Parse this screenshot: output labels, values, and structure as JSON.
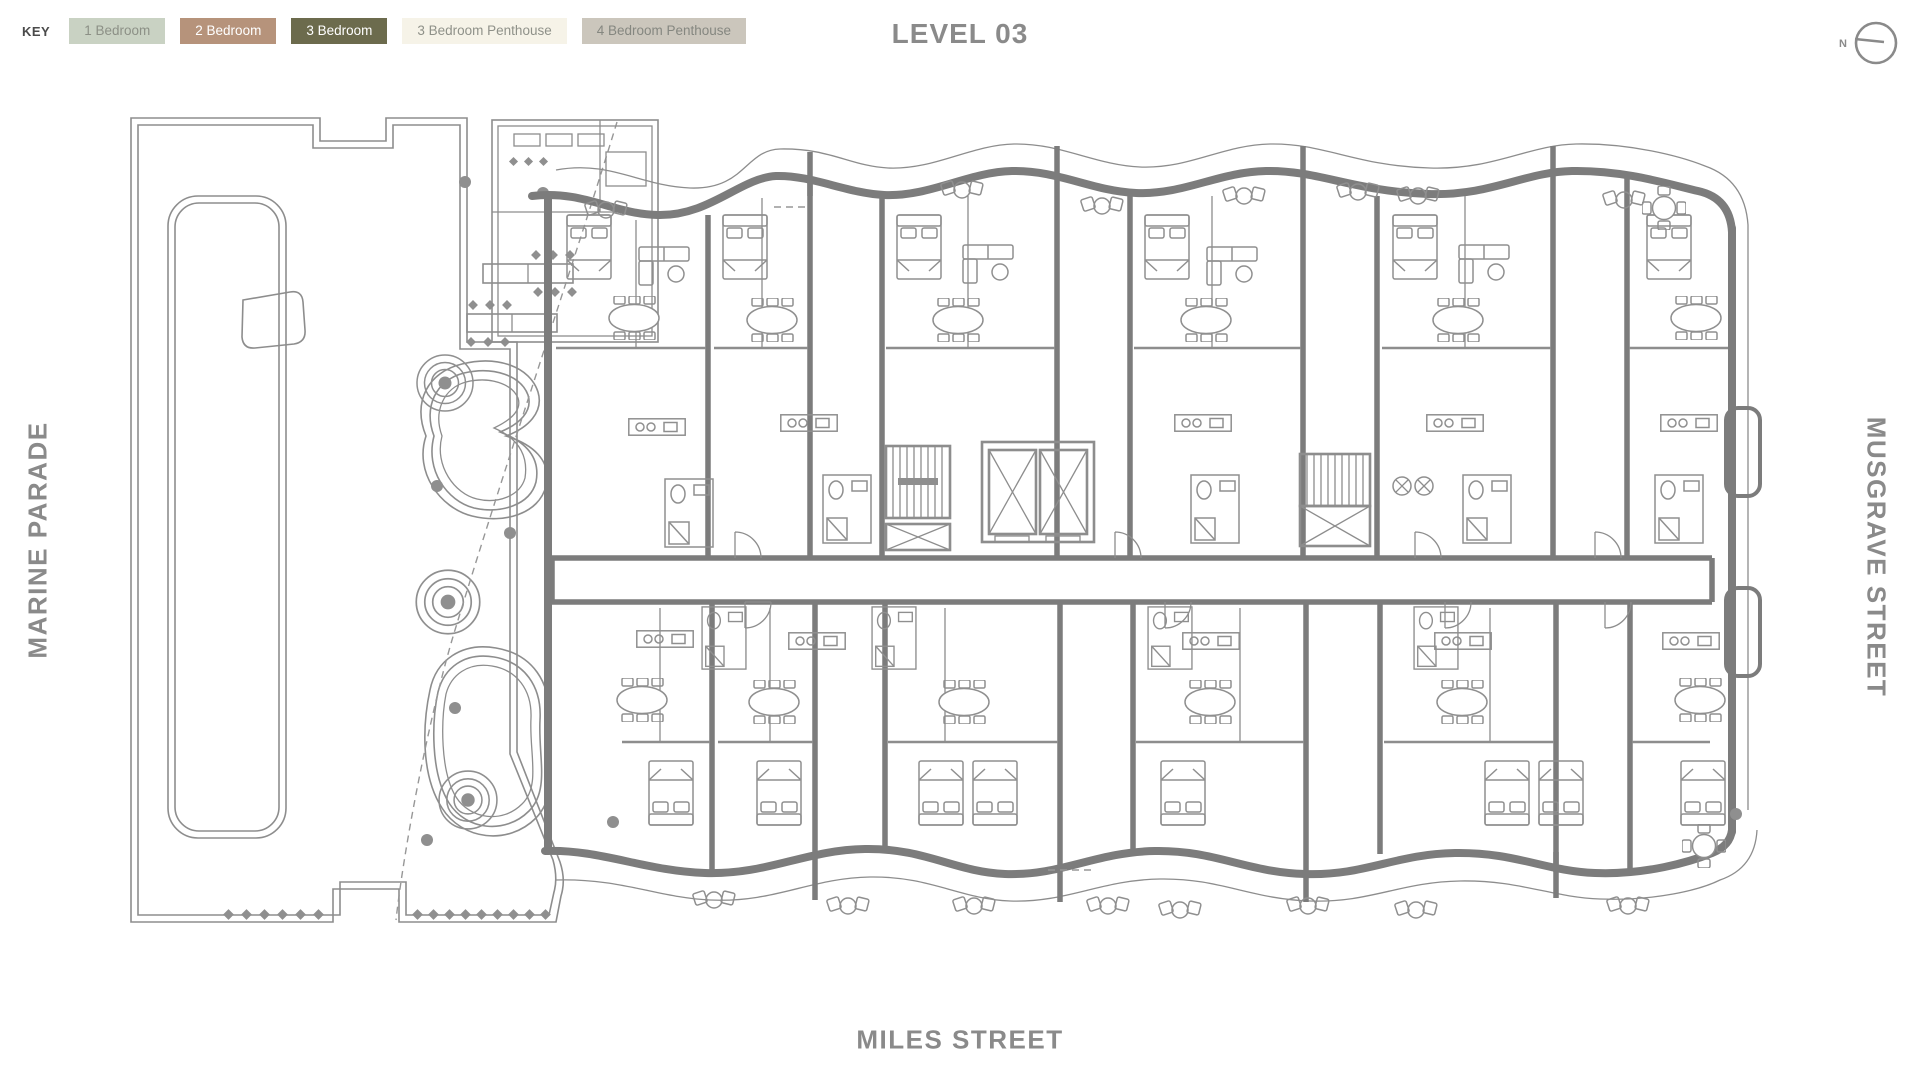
{
  "header": {
    "key_label": "KEY",
    "key_items": [
      {
        "label": "1 Bedroom",
        "bg": "#c9d2c3",
        "fg": "#8c9086"
      },
      {
        "label": "2 Bedroom",
        "bg": "#b6937b",
        "fg": "#ffffff"
      },
      {
        "label": "3 Bedroom",
        "bg": "#6c6b4d",
        "fg": "#ffffff"
      },
      {
        "label": "3 Bedroom Penthouse",
        "bg": "#f6f3e8",
        "fg": "#8f9189"
      },
      {
        "label": "4 Bedroom Penthouse",
        "bg": "#cbc6bc",
        "fg": "#858780"
      }
    ],
    "title": "LEVEL 03"
  },
  "compass": {
    "north_label": "N"
  },
  "streets": {
    "west": "MARINE PARADE",
    "east": "MUSGRAVE STREET",
    "south": "MILES STREET"
  },
  "colors": {
    "linework": "#8d8d8d",
    "walls": "#7c7c7c",
    "labels": "#8a8a8a"
  }
}
